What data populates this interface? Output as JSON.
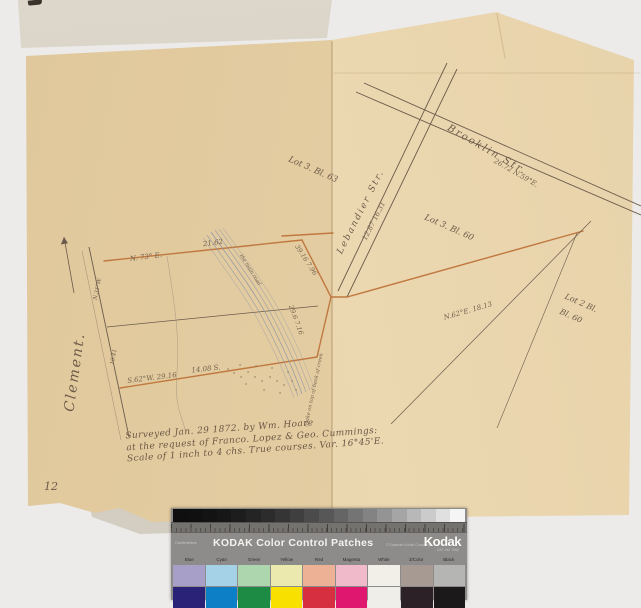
{
  "scan": {
    "page_number": "12",
    "survey_note": {
      "line1": "Surveyed Jan. 29 1872. by Wm. Hoare",
      "line2": "at the request of Franco. Lopez & Geo. Cummings:",
      "line3": "Scale of 1 inch to 4 chs.  True courses.  Var. 16°45'E."
    },
    "map_labels": [
      {
        "t": "Clement.",
        "x": 75,
        "y": 372,
        "r": -82,
        "s": 14,
        "c": "script"
      },
      {
        "t": "Brooklin  Str.",
        "x": 487,
        "y": 150,
        "r": 30,
        "s": 10,
        "c": "script"
      },
      {
        "t": "26.72   N.59°E.",
        "x": 516,
        "y": 173,
        "r": 30,
        "s": 7,
        "c": "meas"
      },
      {
        "t": "Lebandier  Str.",
        "x": 361,
        "y": 212,
        "r": -63,
        "s": 9,
        "c": "script"
      },
      {
        "t": "12.87   16.31",
        "x": 374,
        "y": 221,
        "r": -63,
        "s": 7,
        "c": "meas"
      },
      {
        "t": "Lot 3. Bl. 63",
        "x": 313,
        "y": 170,
        "r": 24,
        "s": 8.5,
        "c": ""
      },
      {
        "t": "Lot 3. Bl. 60",
        "x": 449,
        "y": 228,
        "r": 24,
        "s": 8.5,
        "c": ""
      },
      {
        "t": "Lot 2 Bl.",
        "x": 581,
        "y": 303,
        "r": 24,
        "s": 8,
        "c": ""
      },
      {
        "t": "Bl. 60",
        "x": 571,
        "y": 316,
        "r": 24,
        "s": 8,
        "c": ""
      },
      {
        "t": "N. 73° E.",
        "x": 146,
        "y": 257,
        "r": -7,
        "s": 7,
        "c": "meas"
      },
      {
        "t": "21.62",
        "x": 213,
        "y": 243,
        "r": -7,
        "s": 7,
        "c": "meas"
      },
      {
        "t": "39.16  7.96",
        "x": 306,
        "y": 260,
        "r": 57,
        "s": 6.5,
        "c": "meas"
      },
      {
        "t": "29.6  7.16",
        "x": 296,
        "y": 320,
        "r": 70,
        "s": 6.5,
        "c": "meas"
      },
      {
        "t": "N.62°E.   18.13",
        "x": 468,
        "y": 311,
        "r": -16,
        "s": 7,
        "c": "meas"
      },
      {
        "t": "S.62°W.  29.16",
        "x": 152,
        "y": 378,
        "r": -7,
        "s": 7,
        "c": "meas"
      },
      {
        "t": "14.08 S.",
        "x": 206,
        "y": 369,
        "r": -6,
        "s": 7,
        "c": "meas"
      },
      {
        "t": "the main road",
        "x": 250,
        "y": 270,
        "r": 58,
        "s": 5,
        "c": "meas"
      },
      {
        "t": "Stake on top of bank of creek",
        "x": 314,
        "y": 390,
        "r": -78,
        "s": 5,
        "c": "meas"
      },
      {
        "t": "N.31°W.",
        "x": 98,
        "y": 289,
        "r": -78,
        "s": 5.5,
        "c": "meas"
      },
      {
        "t": "10.41",
        "x": 114,
        "y": 357,
        "r": -78,
        "s": 5.5,
        "c": "meas"
      }
    ]
  },
  "kodak_strip": {
    "ruler_label": "Centimetres",
    "title": "KODAK Color Control Patches",
    "copyright": "© Eastman Kodak Company",
    "brand": "Kodak",
    "catalog": "CAT 152 7654",
    "patch_labels": [
      "Blue",
      "Cyan",
      "Green",
      "Yellow",
      "Red",
      "Magenta",
      "White",
      "3/Color",
      "Black"
    ],
    "pastel_colors": [
      "#a89fc8",
      "#a6d2e8",
      "#add6ae",
      "#ece9ae",
      "#edb295",
      "#f0bacb",
      "#f1efe8",
      "#a69a92",
      "#b5b5b3"
    ],
    "solid_colors": [
      "#2a2277",
      "#0d7fc6",
      "#1e8b45",
      "#f8e000",
      "#d63040",
      "#e0176e",
      "#f0eee8",
      "#2c2126",
      "#1b191a"
    ],
    "ramp_steps": 20
  },
  "colors": {
    "paper_left": "#e2cba0",
    "paper_right": "#e9d5ae",
    "flap": "#d7d1c5",
    "survey_line_orange": "#c0783f",
    "ink": "#6b5b4b",
    "creek": "#8f96a6",
    "background": "#ecebe9"
  }
}
